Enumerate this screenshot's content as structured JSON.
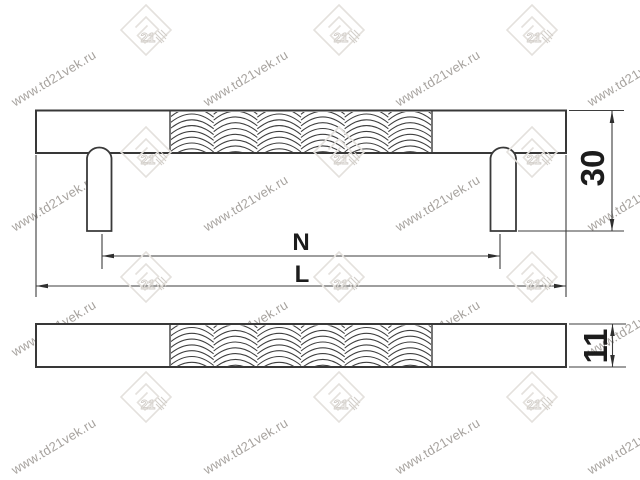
{
  "page": {
    "background": "#ffffff",
    "description_kind": "technical-drawing-of-furniture-handle"
  },
  "watermark": {
    "site_text": "www.td21vek.ru",
    "logo_text": "21",
    "text_color": "#a7a39f",
    "logo_color": "#e4e1dd",
    "logo_hatch_color": "#d2cec9"
  },
  "drawing": {
    "line_color": "#383838",
    "dim_color": "#3d3d3d",
    "views": {
      "front": {
        "name": "front-view-handle-with-posts",
        "dimensions": {
          "height": {
            "label": "30"
          },
          "hole_spacing": {
            "label": "N"
          },
          "overall_length": {
            "label": "L"
          }
        }
      },
      "side": {
        "name": "side-profile-view-bar",
        "dimensions": {
          "diameter": {
            "label": "11"
          }
        }
      }
    }
  }
}
